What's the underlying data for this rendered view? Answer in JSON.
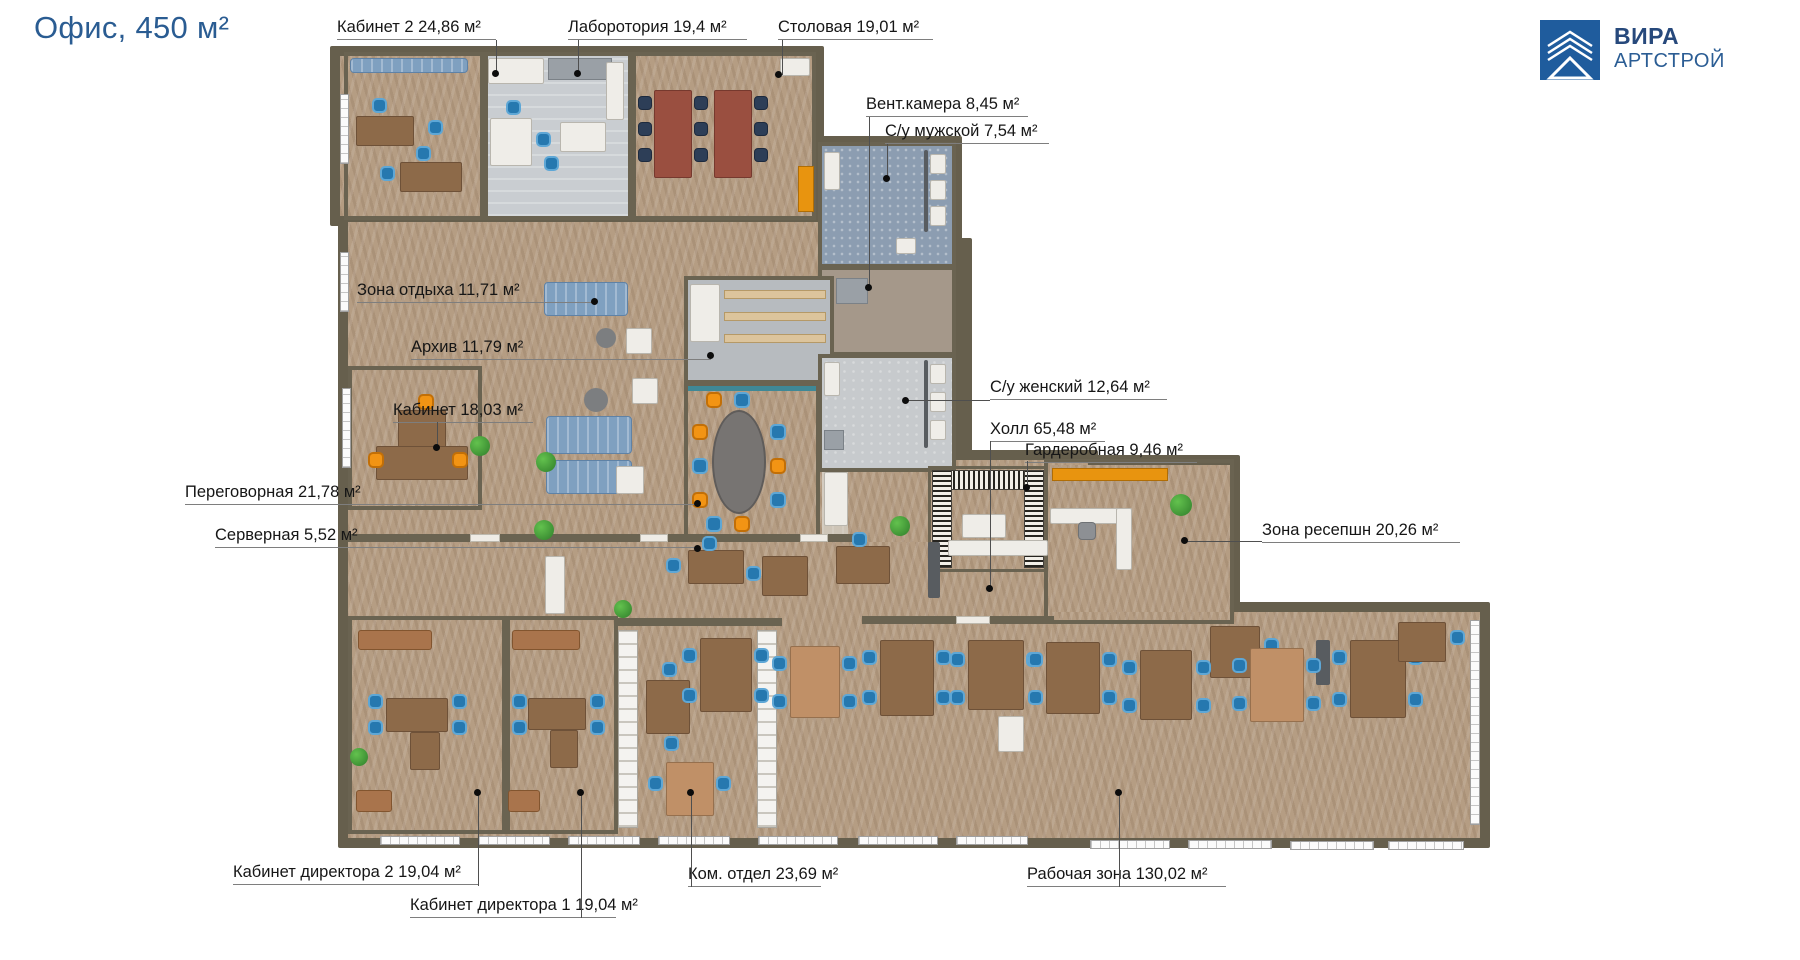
{
  "title": "Офис, 450 м²",
  "logo": {
    "line1": "ВИРА",
    "line2": "АРТСТРОЙ"
  },
  "plan": {
    "total_area_label": "Офис, 450 м²",
    "unit_suffix": "м²",
    "rooms": [
      {
        "id": "cab2",
        "label": "Кабинет 2 24,86 м²"
      },
      {
        "id": "lab",
        "label": "Лаборотория 19,4 м²"
      },
      {
        "id": "dining",
        "label": "Столовая 19,01 м²"
      },
      {
        "id": "vent",
        "label": "Вент.камера 8,45 м²"
      },
      {
        "id": "wc-male",
        "label": "С/у мужской 7,54 м²"
      },
      {
        "id": "rest",
        "label": "Зона отдыха 11,71 м²"
      },
      {
        "id": "archive",
        "label": "Архив 11,79 м²"
      },
      {
        "id": "cabinet",
        "label": "Кабинет 18,03 м²"
      },
      {
        "id": "meeting",
        "label": "Переговорная 21,78 м²"
      },
      {
        "id": "server",
        "label": "Серверная 5,52 м²"
      },
      {
        "id": "wc-female",
        "label": "С/у женский 12,64 м²"
      },
      {
        "id": "hall",
        "label": "Холл 65,48 м²"
      },
      {
        "id": "wardrobe",
        "label": "Гардеробная 9,46 м²"
      },
      {
        "id": "reception",
        "label": "Зона ресепшн 20,26 м²"
      },
      {
        "id": "director2",
        "label": "Кабинет директора 2 19,04 м²"
      },
      {
        "id": "director1",
        "label": "Кабинет директора 1 19,04 м²"
      },
      {
        "id": "komm",
        "label": "Ком. отдел 23,69 м²"
      },
      {
        "id": "work",
        "label": "Рабочая зона 130,02 м²"
      }
    ],
    "colors": {
      "accent_blue": "#2a5c92",
      "wall": "#665f4d",
      "parquet": "#b59d83",
      "chair_blue": "#2678af",
      "chair_orange": "#f29414",
      "logo_blue": "#1f5c9d"
    }
  }
}
